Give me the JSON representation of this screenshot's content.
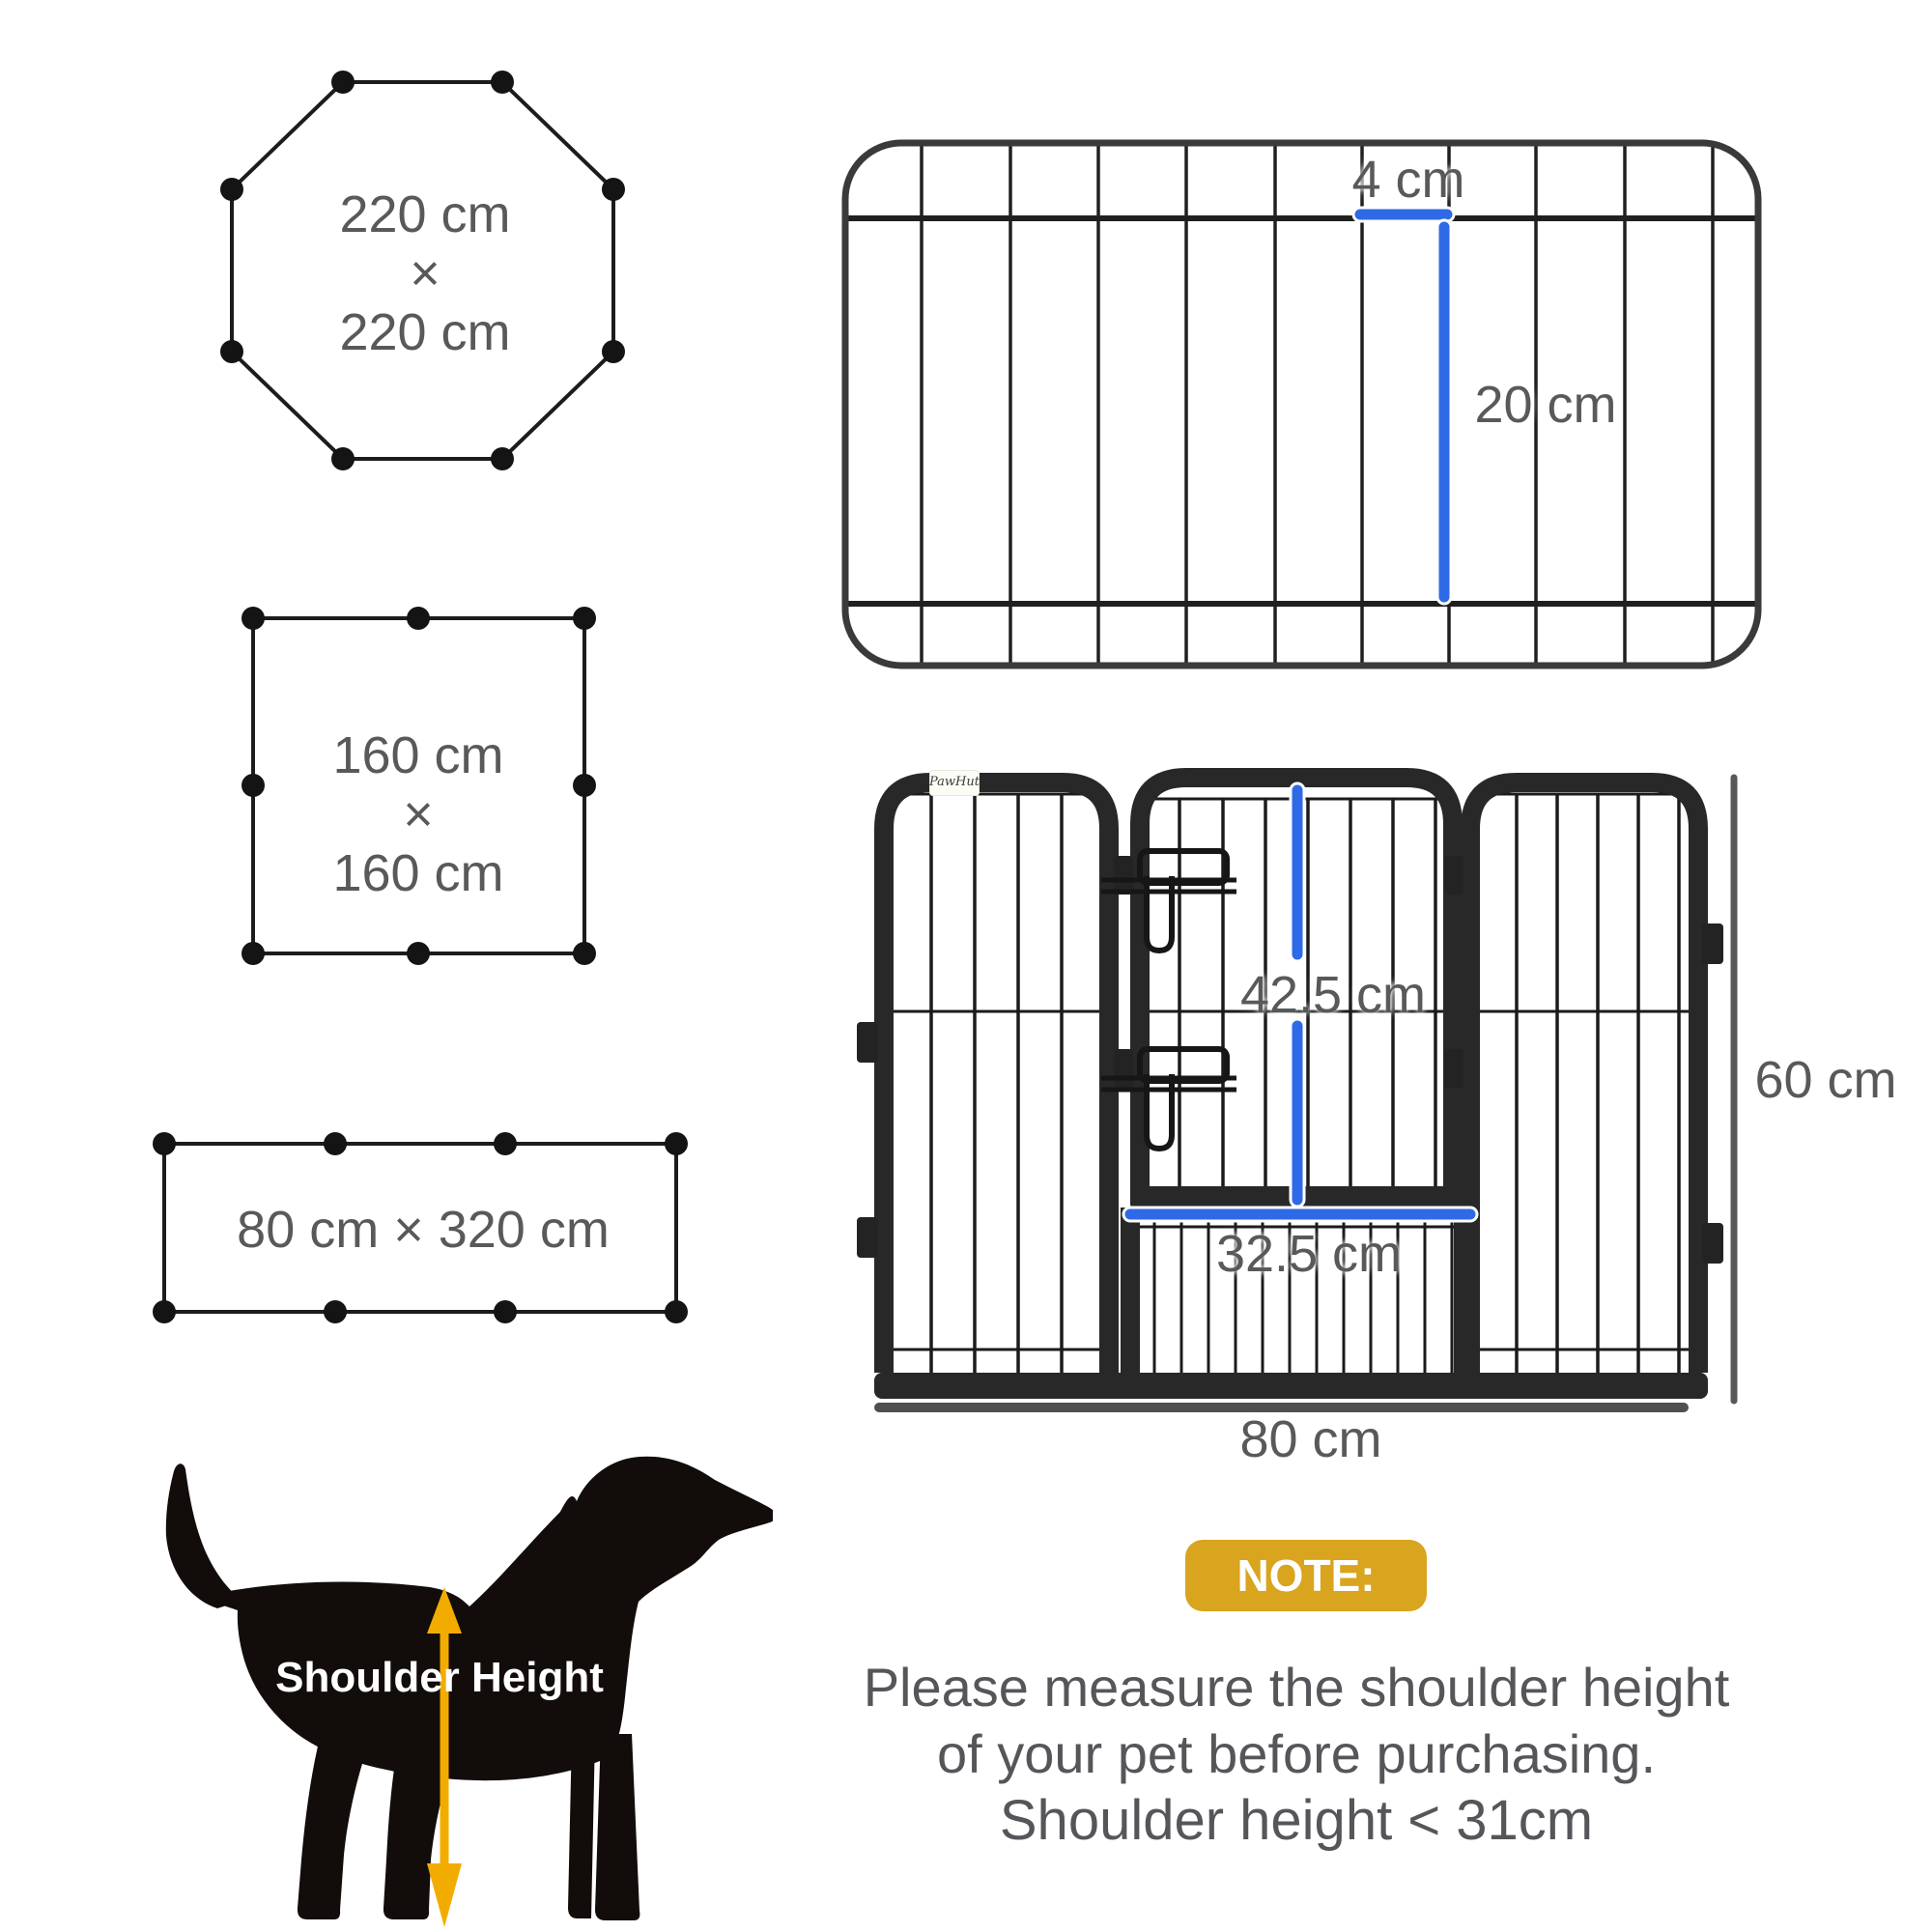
{
  "colors": {
    "accent_blue": "#2e6ae6",
    "arrow_yellow": "#f2ac00",
    "badge_gold": "#d9a41e",
    "label_gray": "#58595b"
  },
  "configurations": {
    "octagon": {
      "line1": "220 cm",
      "times": "×",
      "line2": "220 cm"
    },
    "square": {
      "line1": "160 cm",
      "times": "×",
      "line2": "160 cm"
    },
    "rectangle": {
      "label": "80 cm × 320 cm"
    }
  },
  "panel_top_view": {
    "bar_gap_label": "4 cm",
    "bar_length_label": "20 cm"
  },
  "fence_front_view": {
    "brand": "PawHut",
    "gate_height_label": "42.5 cm",
    "gate_width_label": "32.5 cm",
    "panel_height_label": "60 cm",
    "panel_width_label": "80 cm"
  },
  "dog": {
    "label": "Shoulder Height"
  },
  "note": {
    "badge": "NOTE:",
    "line1": "Please measure the shoulder height",
    "line2": "of your pet before purchasing.",
    "line3": "Shoulder height < 31cm"
  }
}
